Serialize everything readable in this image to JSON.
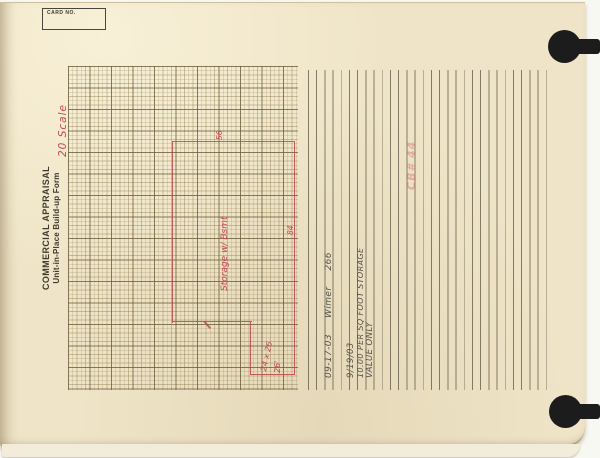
{
  "document": {
    "card_no_label": "CARD NO.",
    "title": {
      "line1": "COMMERCIAL APPRAISAL",
      "line2": "Unit-in-Place  Build-up  Form"
    }
  },
  "red_ink": {
    "scale_note": "20 Scale",
    "building_label": "Storage w/ Bsmt",
    "dim_top": "56",
    "dim_right": "84",
    "scribble1": "24 x 26",
    "scribble2": "26'",
    "faint_stamp": "CB# 44"
  },
  "pencil": {
    "date": "09-17-03",
    "name": "Wimer",
    "number": "266",
    "note_date": "9/19/03",
    "note_rate": "10.00 PER SQ FOOT STORAGE",
    "note_qualifier": "VALUE ONLY"
  },
  "colors": {
    "card_bg": "#efe4c7",
    "grid_line": "#93815c",
    "red_ink": "#c0444b",
    "pencil": "#55524a",
    "rule_line": "#6f6a58"
  }
}
